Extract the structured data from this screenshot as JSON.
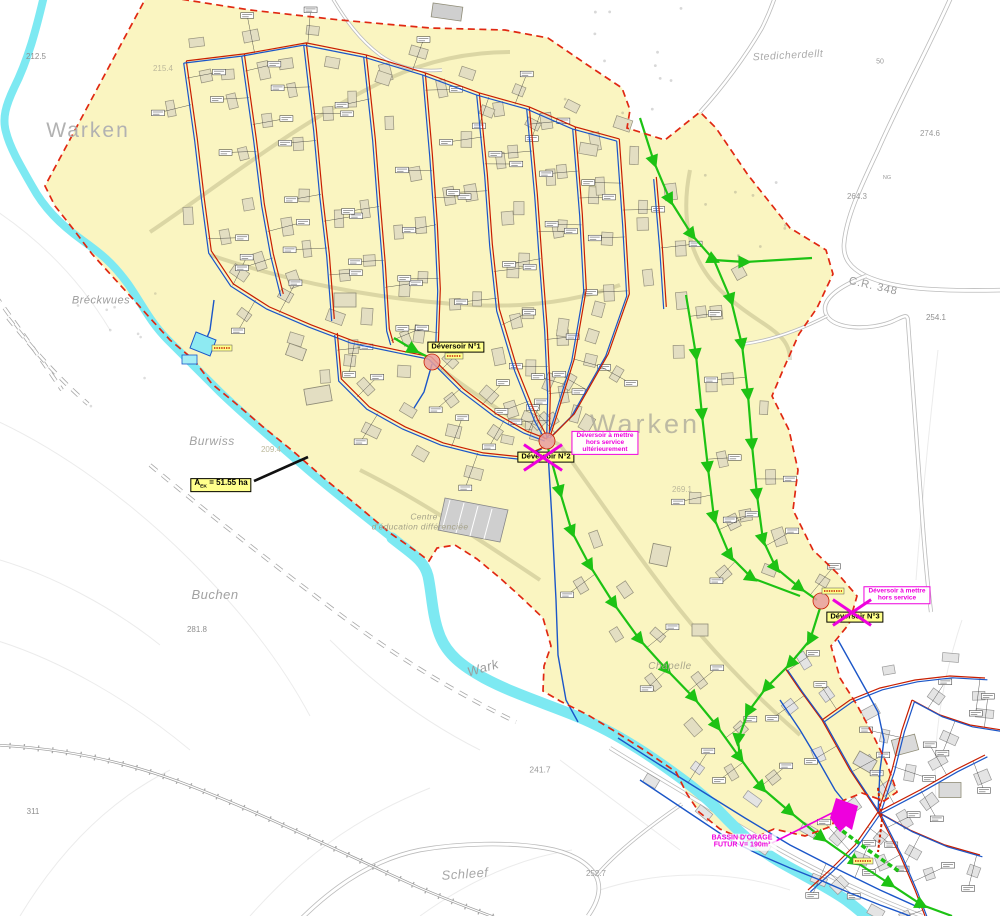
{
  "colors": {
    "river": "#7DE9F2",
    "catchment_fill": "#FAF5C1",
    "boundary_red": "#E02812",
    "sewer_red": "#C81E00",
    "water_blue": "#1B56C8",
    "planned_green": "#1DC214",
    "highlight_magenta": "#EE00DD",
    "label_yellow": "#FFFF8C",
    "building_fill": "#E3DEC2",
    "building_outline": "#96927C",
    "village_building_fill": "#E4E4E4",
    "village_building_outline": "#9A9A9A",
    "road_gray": "#BBBBBB",
    "basin_cyan": "#8EEAF2"
  },
  "place_labels": [
    {
      "text": "Warken",
      "x": 88,
      "y": 131,
      "size": 21,
      "color": "#B2B2B2",
      "italic": false,
      "rotate": 0,
      "opacity": 1,
      "spacing": 2
    },
    {
      "text": "Warken",
      "x": 645,
      "y": 424,
      "size": 27,
      "color": "#AFAC9C",
      "italic": false,
      "rotate": 0,
      "opacity": 0.8,
      "spacing": 3
    },
    {
      "text": "Bréckwues",
      "x": 101,
      "y": 301,
      "size": 11,
      "color": "#9C9C9C",
      "italic": true,
      "rotate": 0,
      "opacity": 1,
      "spacing": 0.5
    },
    {
      "text": "Burwiss",
      "x": 212,
      "y": 441,
      "size": 12,
      "color": "#A2A2A2",
      "italic": true,
      "rotate": 0,
      "opacity": 1,
      "spacing": 0.5
    },
    {
      "text": "Buchen",
      "x": 215,
      "y": 595,
      "size": 13,
      "color": "#A2A2A2",
      "italic": true,
      "rotate": 0,
      "opacity": 1,
      "spacing": 0.5
    },
    {
      "text": "Stedicherdellt",
      "x": 788,
      "y": 56,
      "size": 10.5,
      "color": "#ABABAB",
      "italic": true,
      "rotate": -3,
      "opacity": 1,
      "spacing": 0.5
    },
    {
      "text": "Schleef",
      "x": 465,
      "y": 874,
      "size": 13,
      "color": "#A8A8A8",
      "italic": true,
      "rotate": -4,
      "opacity": 1,
      "spacing": 0.5
    },
    {
      "text": "Wark",
      "x": 483,
      "y": 668,
      "size": 13,
      "color": "#9C9C9C",
      "italic": true,
      "rotate": -16,
      "opacity": 1,
      "spacing": 0.5
    },
    {
      "text": "Chapelle",
      "x": 670,
      "y": 667,
      "size": 10,
      "color": "#A9A68C",
      "italic": true,
      "rotate": 0,
      "opacity": 1,
      "spacing": 0.5
    },
    {
      "text": "Centre",
      "x": 424,
      "y": 517,
      "size": 8.5,
      "color": "#A5A289",
      "italic": true,
      "rotate": 0,
      "opacity": 1,
      "spacing": 0.3
    },
    {
      "text": "d'éducation différenciée",
      "x": 420,
      "y": 527,
      "size": 8.5,
      "color": "#A5A289",
      "italic": true,
      "rotate": 0,
      "opacity": 1,
      "spacing": 0.3
    },
    {
      "text": "C.R. 348",
      "x": 873,
      "y": 287,
      "size": 11,
      "color": "#9A9A9A",
      "italic": false,
      "rotate": 13,
      "opacity": 1,
      "spacing": 0.8
    }
  ],
  "elevations": [
    {
      "text": "212.5",
      "x": 36,
      "y": 57,
      "size": 8,
      "color": "#8E8E8E"
    },
    {
      "text": "215.4",
      "x": 163,
      "y": 69,
      "size": 8,
      "color": "#BCB89B"
    },
    {
      "text": "50",
      "x": 880,
      "y": 62,
      "size": 7,
      "color": "#9A9A9A"
    },
    {
      "text": "274.6",
      "x": 930,
      "y": 134,
      "size": 8,
      "color": "#9A9A9A"
    },
    {
      "text": "NG",
      "x": 887,
      "y": 179,
      "size": 5.5,
      "color": "#9A9A9A"
    },
    {
      "text": "264.3",
      "x": 857,
      "y": 197,
      "size": 8,
      "color": "#9A9A9A"
    },
    {
      "text": "254.1",
      "x": 936,
      "y": 318,
      "size": 8,
      "color": "#8E8E8E"
    },
    {
      "text": "209.4",
      "x": 271,
      "y": 450,
      "size": 8,
      "color": "#BCB89B"
    },
    {
      "text": "269.1",
      "x": 682,
      "y": 490,
      "size": 8,
      "color": "#BCB89B"
    },
    {
      "text": "281.8",
      "x": 197,
      "y": 630,
      "size": 8,
      "color": "#8E8E8E"
    },
    {
      "text": "311",
      "x": 33,
      "y": 812,
      "size": 8,
      "color": "#8E8E8E"
    },
    {
      "text": "241.7",
      "x": 540,
      "y": 770,
      "size": 8.5,
      "color": "#9A9A9A"
    },
    {
      "text": "252.7",
      "x": 596,
      "y": 874,
      "size": 8,
      "color": "#9A9A9A"
    }
  ],
  "deversoirs": [
    {
      "label": "Déversoir N°1",
      "box_x": 456,
      "box_y": 347,
      "circle_x": 432,
      "circle_y": 362,
      "crossed": false,
      "cross_x": 0,
      "cross_y": 0
    },
    {
      "label": "Déversoir N°2",
      "box_x": 546,
      "box_y": 457,
      "circle_x": 547,
      "circle_y": 441,
      "crossed": true,
      "cross_x": 543,
      "cross_y": 457
    },
    {
      "label": "Déversoir N°3",
      "box_x": 855,
      "box_y": 617,
      "circle_x": 821,
      "circle_y": 601,
      "crossed": true,
      "cross_x": 852,
      "cross_y": 612
    }
  ],
  "notes": [
    {
      "lines": [
        "Déversoir à mettre",
        "hors service",
        "ultérieurement"
      ],
      "x": 605,
      "y": 443,
      "bordered": true,
      "size": 6.5
    },
    {
      "lines": [
        "Déversoir à mettre",
        "hors service"
      ],
      "x": 897,
      "y": 595,
      "bordered": true,
      "size": 6.5
    },
    {
      "lines": [
        "BASSIN D'ORAGE",
        "FUTUR   V= 190m³"
      ],
      "x": 742,
      "y": 842,
      "bordered": false,
      "size": 7
    }
  ],
  "area_label": {
    "prefix": "A",
    "sub": "EK",
    "rest": " = 51.55 ha",
    "x": 221,
    "y": 485
  }
}
